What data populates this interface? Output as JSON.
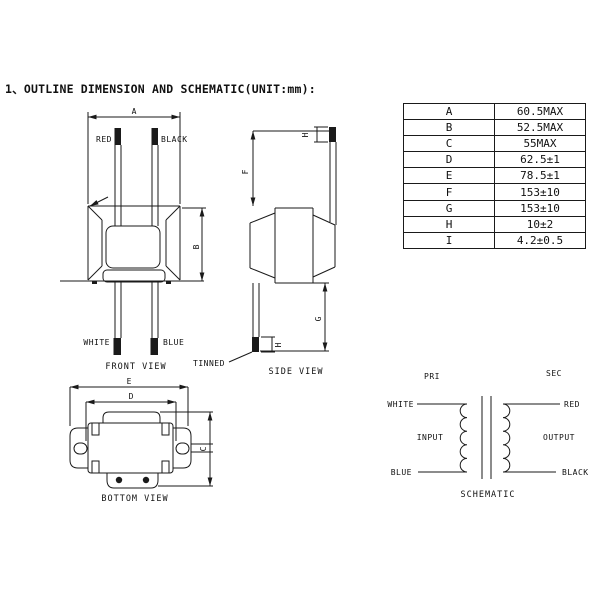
{
  "title": "1、OUTLINE DIMENSION AND SCHEMATIC(UNIT:mm):",
  "dimension_table": {
    "rows": [
      {
        "param": "A",
        "value": "60.5MAX"
      },
      {
        "param": "B",
        "value": "52.5MAX"
      },
      {
        "param": "C",
        "value": "55MAX"
      },
      {
        "param": "D",
        "value": "62.5±1"
      },
      {
        "param": "E",
        "value": "78.5±1"
      },
      {
        "param": "F",
        "value": "153±10"
      },
      {
        "param": "G",
        "value": "153±10"
      },
      {
        "param": "H",
        "value": "10±2"
      },
      {
        "param": "I",
        "value": "4.2±0.5"
      }
    ]
  },
  "front_view": {
    "caption": "FRONT VIEW",
    "wire_labels": {
      "top_left": "RED",
      "top_right": "BLACK",
      "bottom_left": "WHITE",
      "bottom_right": "BLUE"
    },
    "dims": {
      "width": "A",
      "height": "B"
    }
  },
  "side_view": {
    "caption": "SIDE VIEW",
    "tinned_label": "TINNED",
    "dims": {
      "top_wire": "F",
      "bottom_wire": "G",
      "tip_top": "H",
      "tip_bottom": "H"
    }
  },
  "bottom_view": {
    "caption": "BOTTOM VIEW",
    "dims": {
      "overall_width": "E",
      "slot_span": "D",
      "depth": "C"
    }
  },
  "schematic": {
    "caption": "SCHEMATIC",
    "primary_label": "PRI",
    "secondary_label": "SEC",
    "input_label": "INPUT",
    "output_label": "OUTPUT",
    "leads": {
      "pri_top": "WHITE",
      "pri_bottom": "BLUE",
      "sec_top": "RED",
      "sec_bottom": "BLACK"
    }
  },
  "colors": {
    "line": "#1a1a1a",
    "background": "#ffffff"
  }
}
